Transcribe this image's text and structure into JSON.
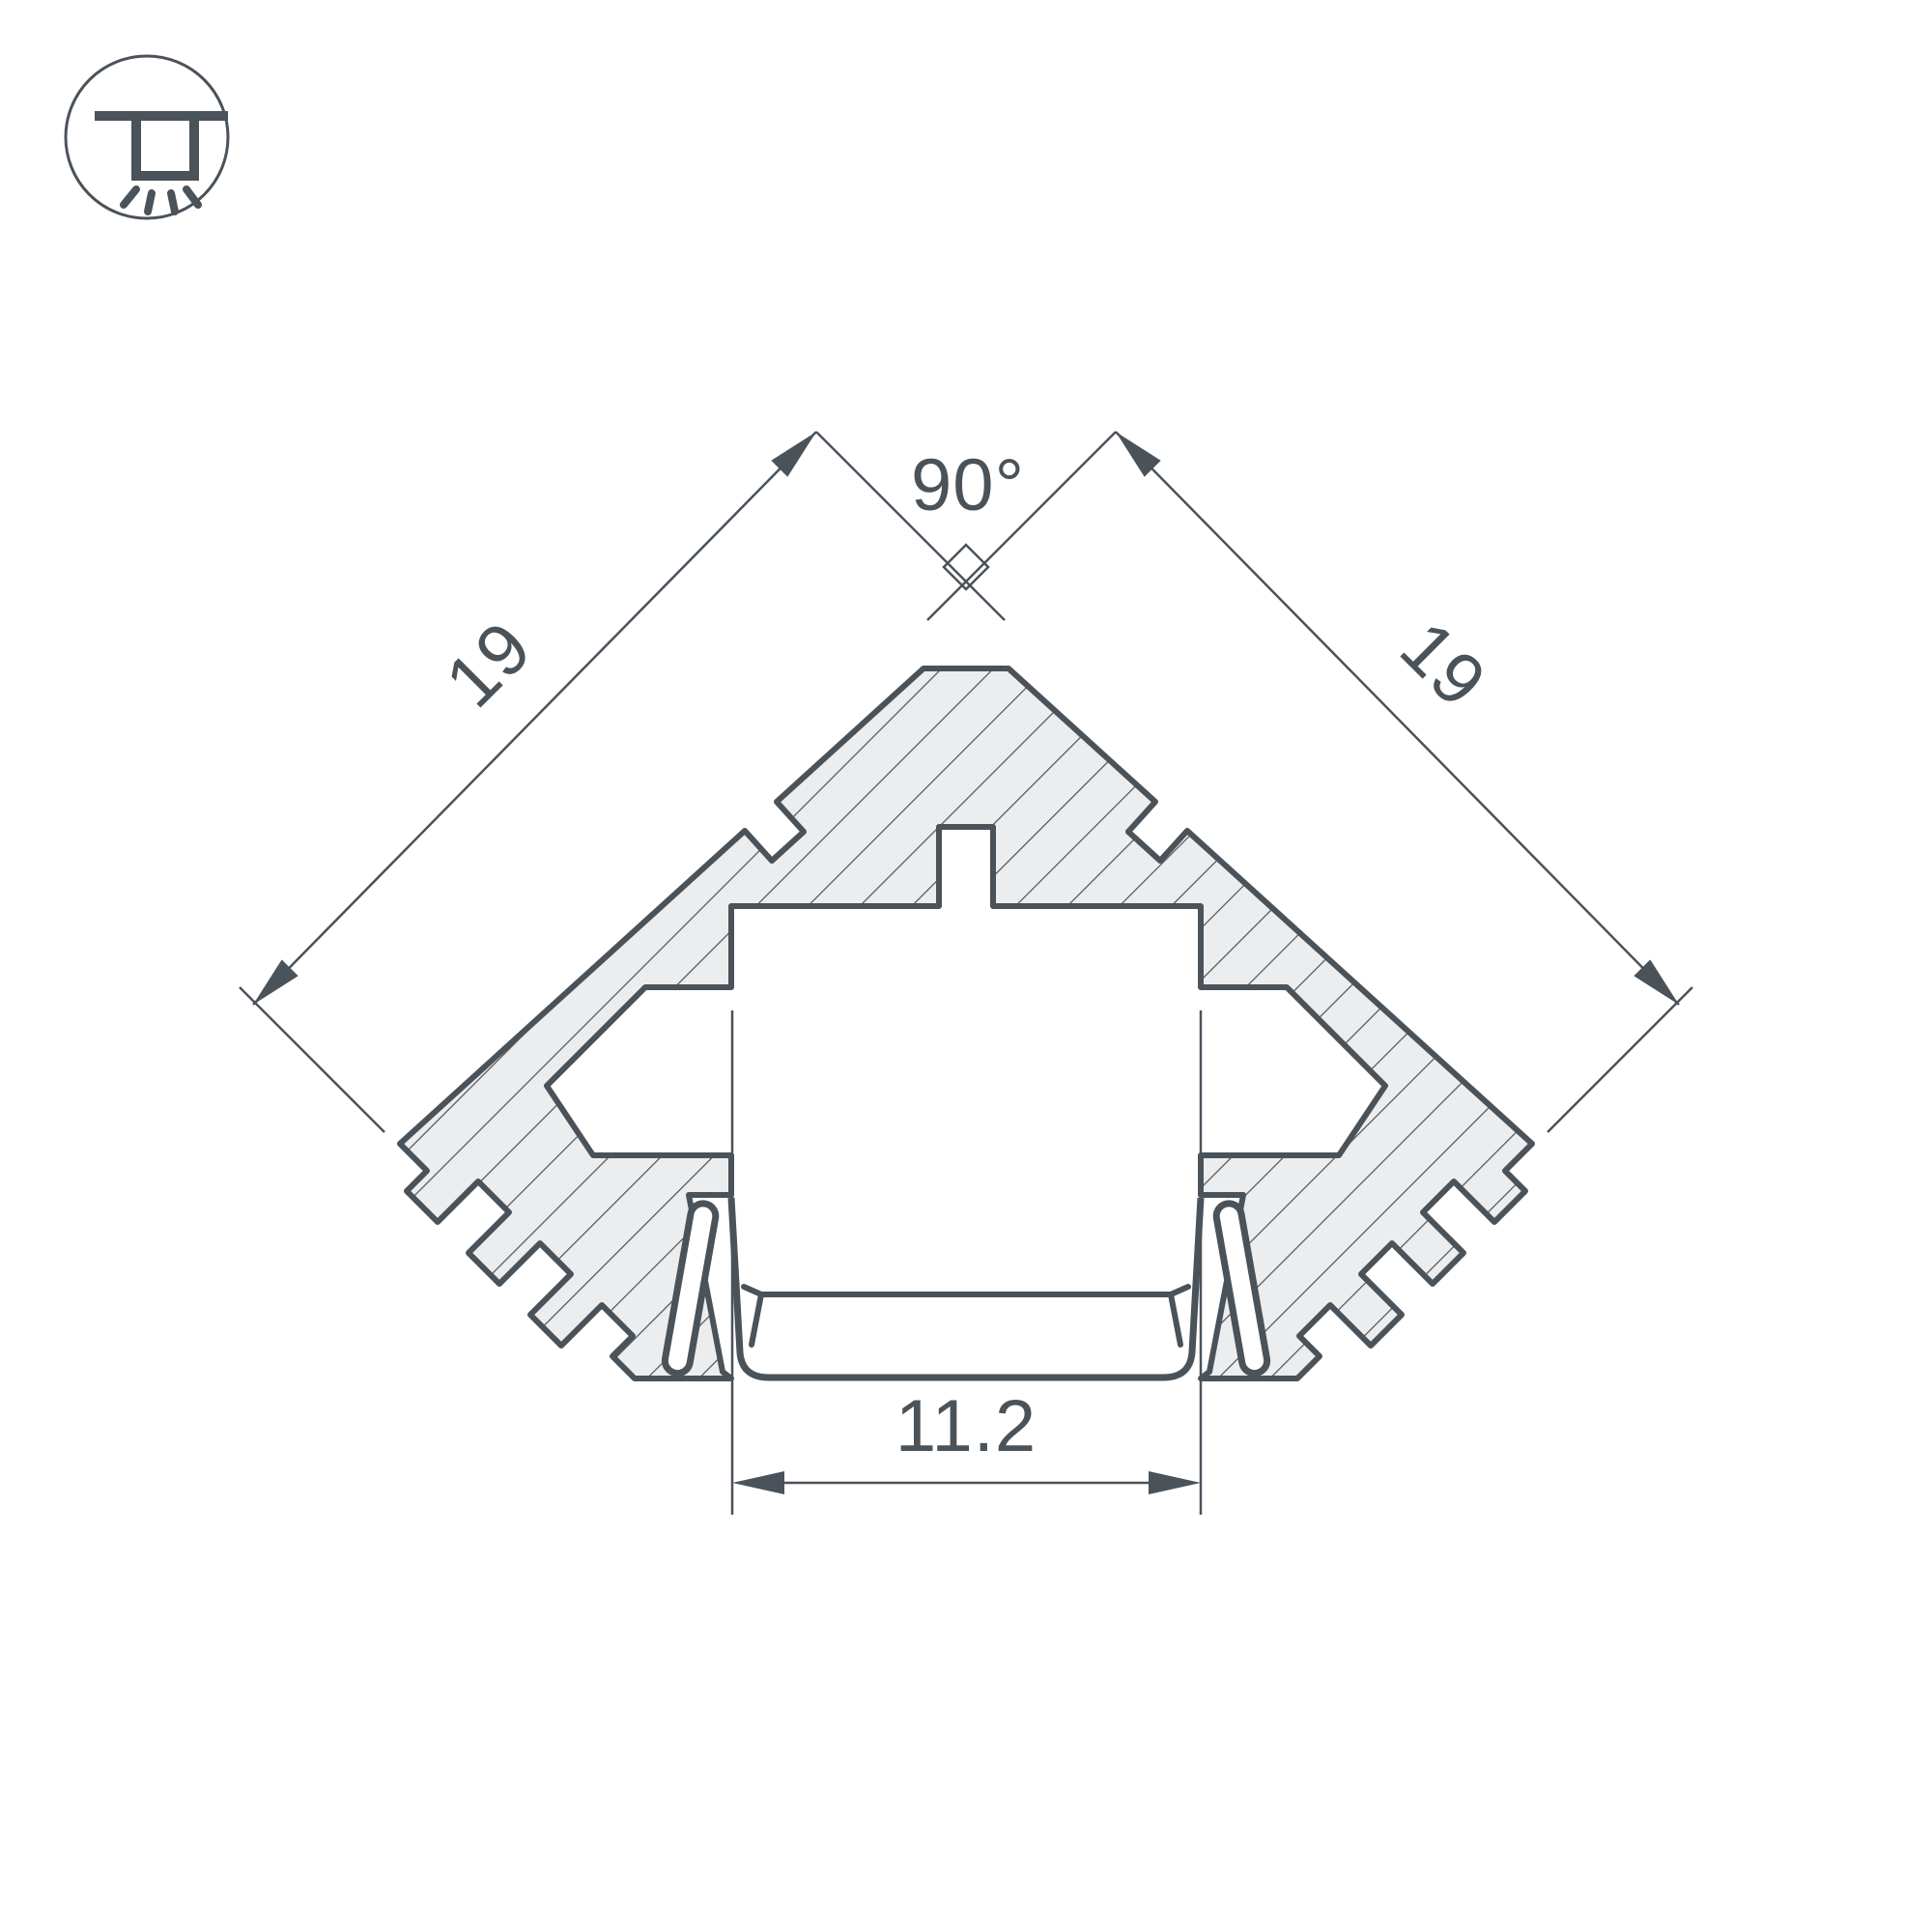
{
  "icon": {
    "name": "recessed-ceiling-light",
    "meaning": "ceiling / surface mount lighting pictogram"
  },
  "drawing": {
    "type": "profile-cross-section",
    "description": "90-degree corner LED profile cross-section with hatched aluminum body, LED tray, diffuser and spring clips"
  },
  "dimensions": {
    "angle": "90°",
    "side_left": "19",
    "side_right": "19",
    "width_bottom": "11.2"
  },
  "colors": {
    "line": "#4a525a",
    "hatch_fill": "#ecedee",
    "background": "#ffffff"
  }
}
